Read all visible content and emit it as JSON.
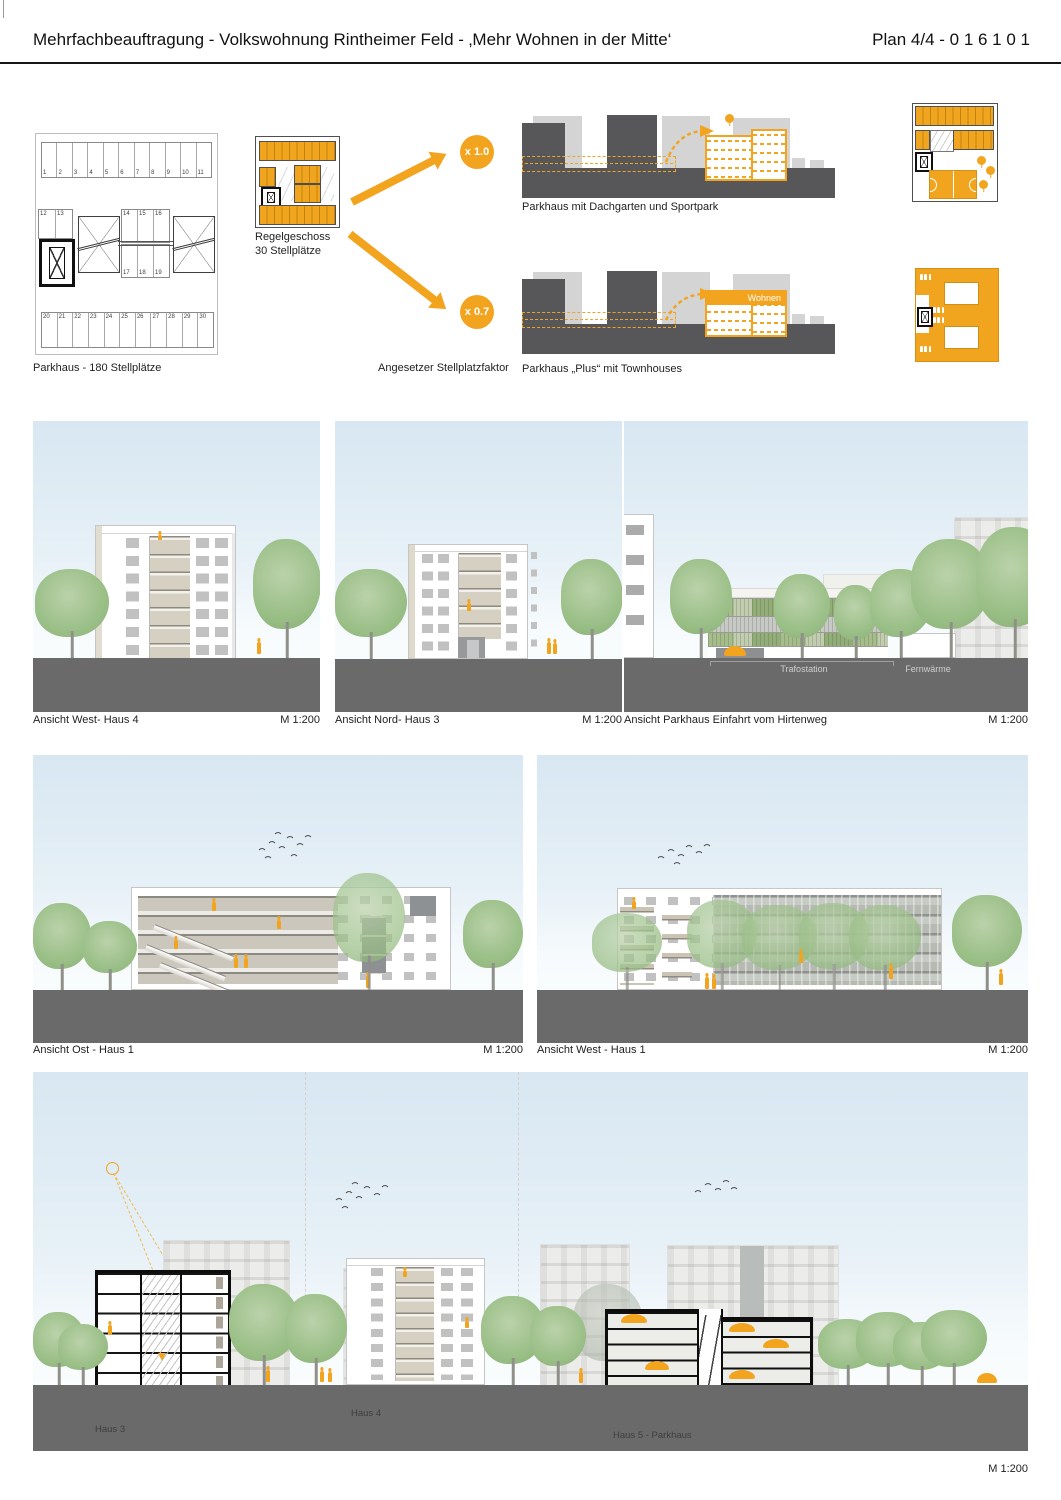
{
  "header": {
    "title": "Mehrfachbeauftragung - Volkswohnung Rintheimer Feld - ‚Mehr Wohnen in der Mitte‘",
    "plan_label": "Plan 4/4  - 0 1 6 1 0 1"
  },
  "concept": {
    "parkhaus_plan": {
      "caption": "Parkhaus - 180 Stellplätze",
      "stalls_top": [
        "1",
        "2",
        "3",
        "4",
        "5",
        "6",
        "7",
        "8",
        "9",
        "10",
        "11"
      ],
      "stalls_mid_left": [
        "12",
        "13"
      ],
      "stalls_mid_top": [
        "14",
        "15",
        "16"
      ],
      "stalls_mid_bottom": [
        "17",
        "18",
        "19"
      ],
      "stalls_bottom": [
        "20",
        "21",
        "22",
        "23",
        "24",
        "25",
        "26",
        "27",
        "28",
        "29",
        "30"
      ]
    },
    "regelgeschoss": {
      "line1": "Regelgeschoss",
      "line2": "30 Stellplätze"
    },
    "factor": {
      "label": "Angesetzer Stellplatzfaktor",
      "top": "x 1.0",
      "bottom": "x 0.7"
    },
    "options": {
      "top_caption": "Parkhaus mit Dachgarten und Sportpark",
      "bottom_caption": "Parkhaus „Plus“ mit Townhouses",
      "wohnen": "Wohnen"
    }
  },
  "elevations": {
    "west_haus4": {
      "caption": "Ansicht West- Haus 4",
      "scale": "M 1:200"
    },
    "nord_haus3": {
      "caption": "Ansicht Nord- Haus 3",
      "scale": "M 1:200"
    },
    "parkhaus_einfahrt": {
      "caption": "Ansicht Parkhaus Einfahrt vom Hirtenweg",
      "scale": "M 1:200",
      "trafostation": "Trafostation",
      "fernwaerme": "Fernwärme"
    },
    "ost_haus1": {
      "caption": "Ansicht Ost - Haus 1",
      "scale": "M 1:200"
    },
    "west_haus1": {
      "caption": "Ansicht West - Haus 1",
      "scale": "M 1:200"
    }
  },
  "section": {
    "scale": "M 1:200",
    "haus3": "Haus 3",
    "haus4": "Haus 4",
    "haus5": "Haus 5 - Parkhaus"
  },
  "colors": {
    "accent": "#F2A41F",
    "ground": "#6A6A6A",
    "building_dark": "#57575A",
    "building_light": "#D4D4D4"
  }
}
